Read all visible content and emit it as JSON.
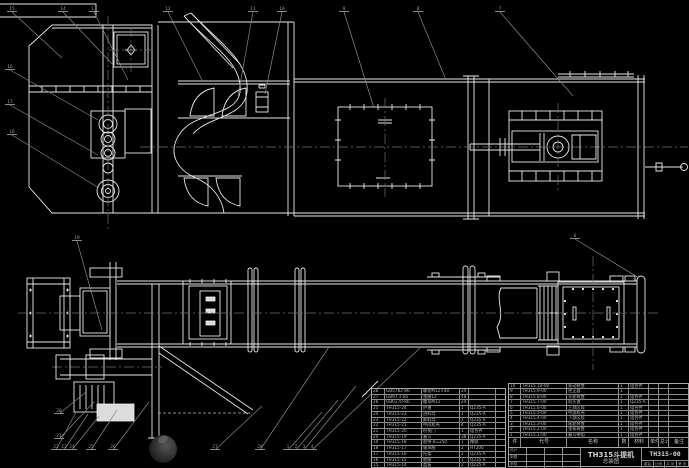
{
  "meta": {
    "background": "#000000",
    "line_color": "#e9e9e9",
    "centerline_color": "#6f6f6f",
    "callout_color": "#9a9a9a"
  },
  "title_block": {
    "product": "TH315斗提机",
    "sheet_name": "总装图",
    "drawing_no": "TH315-00",
    "fields": {
      "weight": "重量",
      "scale": "比例",
      "sheets": "共 张",
      "sheet_no": "第 张"
    },
    "sign_rows": [
      {
        "label": "设计"
      },
      {
        "label": "制图"
      },
      {
        "label": "审核"
      }
    ]
  },
  "bom_right": {
    "headers": [
      "件",
      "代号",
      "名称",
      "数",
      "材料",
      "单件",
      "总计",
      "备注"
    ],
    "rows": [
      {
        "no": "10",
        "code": "TH315.10-00",
        "name": "驱动装置",
        "qty": "1",
        "mat": "组合件",
        "w1": "",
        "w2": "",
        "note": ""
      },
      {
        "no": "9",
        "code": "TH315.9-00",
        "name": "逆止器",
        "qty": "1",
        "mat": "",
        "w1": "",
        "w2": "",
        "note": ""
      },
      {
        "no": "8",
        "code": "TH315.8-00",
        "name": "头轮装置",
        "qty": "1",
        "mat": "组合件",
        "w1": "",
        "w2": "",
        "note": ""
      },
      {
        "no": "7",
        "code": "TH315.7-00",
        "name": "机头罩",
        "qty": "1",
        "mat": "Q235-A",
        "w1": "",
        "w2": "",
        "note": ""
      },
      {
        "no": "6",
        "code": "TH315.6-00",
        "name": "上部区段",
        "qty": "1",
        "mat": "组合件",
        "w1": "",
        "w2": "",
        "note": ""
      },
      {
        "no": "5",
        "code": "TH315.5-00",
        "name": "中部机壳",
        "qty": "1",
        "mat": "组合件",
        "w1": "",
        "w2": "",
        "note": ""
      },
      {
        "no": "4",
        "code": "TH315.4-00",
        "name": "下部区段",
        "qty": "1",
        "mat": "组合件",
        "w1": "",
        "w2": "",
        "note": ""
      },
      {
        "no": "3",
        "code": "TH315.3-00",
        "name": "尾轮装置",
        "qty": "1",
        "mat": "组合件",
        "w1": "",
        "w2": "",
        "note": ""
      },
      {
        "no": "2",
        "code": "TH315.2-00",
        "name": "张紧装置",
        "qty": "1",
        "mat": "组合件",
        "w1": "",
        "w2": "",
        "note": ""
      },
      {
        "no": "1",
        "code": "TH315.1-00",
        "name": "畚斗带组",
        "qty": "1",
        "mat": "组合件",
        "w1": "",
        "w2": "",
        "note": ""
      }
    ]
  },
  "bom_left": {
    "rows": [
      {
        "no": "28",
        "code": "GB5782-86",
        "name": "螺栓M12×40",
        "qty": "24",
        "mat": "",
        "note": ""
      },
      {
        "no": "27",
        "code": "GB97.1-85",
        "name": "垫圈12",
        "qty": "48",
        "mat": "",
        "note": ""
      },
      {
        "no": "26",
        "code": "GB6170-86",
        "name": "螺母M12",
        "qty": "24",
        "mat": "",
        "note": ""
      },
      {
        "no": "25",
        "code": "TH315-24",
        "name": "护罩",
        "qty": "1",
        "mat": "Q235-A",
        "note": ""
      },
      {
        "no": "24",
        "code": "TH315-23",
        "name": "进料口",
        "qty": "1",
        "mat": "Q235-A",
        "note": ""
      },
      {
        "no": "23",
        "code": "TH315-22",
        "name": "卸料口",
        "qty": "1",
        "mat": "Q235-A",
        "note": ""
      },
      {
        "no": "22",
        "code": "TH315-21",
        "name": "中间机壳",
        "qty": "4",
        "mat": "Q235-A",
        "note": ""
      },
      {
        "no": "21",
        "code": "TH315-20",
        "name": "检视门",
        "qty": "1",
        "mat": "组合件",
        "note": ""
      },
      {
        "no": "20",
        "code": "TH315-19",
        "name": "畚斗",
        "qty": "38",
        "mat": "Q235-A",
        "note": ""
      },
      {
        "no": "19",
        "code": "TH315-18",
        "name": "胶带 B=250",
        "qty": "1",
        "mat": "橡胶",
        "note": ""
      },
      {
        "no": "18",
        "code": "TH315-17",
        "name": "轴承座",
        "qty": "2",
        "mat": "HT200",
        "note": ""
      },
      {
        "no": "17",
        "code": "TH315-16",
        "name": "托架",
        "qty": "1",
        "mat": "Q235-A",
        "note": ""
      },
      {
        "no": "16",
        "code": "TH315-15",
        "name": "底座",
        "qty": "1",
        "mat": "Q235-A",
        "note": ""
      },
      {
        "no": "15",
        "code": "TH315-14",
        "name": "盖板",
        "qty": "2",
        "mat": "Q235-A",
        "note": ""
      }
    ]
  },
  "callouts": [
    {
      "n": "15",
      "lx": 10,
      "ly": 9,
      "px": 62,
      "py": 58
    },
    {
      "n": "14",
      "lx": 61,
      "ly": 9,
      "px": 116,
      "py": 68
    },
    {
      "n": "13",
      "lx": 92,
      "ly": 9,
      "px": 128,
      "py": 80
    },
    {
      "n": "12",
      "lx": 166,
      "ly": 9,
      "px": 202,
      "py": 80
    },
    {
      "n": "11",
      "lx": 251,
      "ly": 9,
      "px": 238,
      "py": 96
    },
    {
      "n": "10",
      "lx": 280,
      "ly": 9,
      "px": 265,
      "py": 94
    },
    {
      "n": "9",
      "lx": 342,
      "ly": 9,
      "px": 374,
      "py": 108
    },
    {
      "n": "8",
      "lx": 416,
      "ly": 9,
      "px": 446,
      "py": 80
    },
    {
      "n": "7",
      "lx": 498,
      "ly": 9,
      "px": 573,
      "py": 96
    },
    {
      "n": "16",
      "lx": 8,
      "ly": 67,
      "px": 98,
      "py": 120
    },
    {
      "n": "17",
      "lx": 8,
      "ly": 102,
      "px": 98,
      "py": 155
    },
    {
      "n": "18",
      "lx": 10,
      "ly": 132,
      "px": 99,
      "py": 188
    },
    {
      "n": "19",
      "lx": 75,
      "ly": 238,
      "px": 102,
      "py": 330
    },
    {
      "n": "6",
      "lx": 573,
      "ly": 236,
      "px": 639,
      "py": 278
    },
    {
      "n": "20",
      "lx": 57,
      "ly": 411,
      "px": 86,
      "py": 392
    },
    {
      "n": "21",
      "lx": 57,
      "ly": 436,
      "px": 94,
      "py": 402
    },
    {
      "n": "22",
      "lx": 54,
      "ly": 447,
      "px": 76,
      "py": 412
    },
    {
      "n": "23",
      "lx": 62,
      "ly": 447,
      "px": 88,
      "py": 414
    },
    {
      "n": "24",
      "lx": 70,
      "ly": 447,
      "px": 99,
      "py": 416
    },
    {
      "n": "25",
      "lx": 89,
      "ly": 447,
      "px": 117,
      "py": 410
    },
    {
      "n": "26",
      "lx": 111,
      "ly": 447,
      "px": 149,
      "py": 402
    },
    {
      "n": "27",
      "lx": 213,
      "ly": 447,
      "px": 262,
      "py": 406
    },
    {
      "n": "28",
      "lx": 258,
      "ly": 447,
      "px": 329,
      "py": 347
    },
    {
      "n": "1",
      "lx": 286,
      "ly": 447,
      "px": 322,
      "py": 412
    },
    {
      "n": "2",
      "lx": 294,
      "ly": 447,
      "px": 338,
      "py": 400
    },
    {
      "n": "3",
      "lx": 302,
      "ly": 447,
      "px": 356,
      "py": 386
    },
    {
      "n": "4",
      "lx": 310,
      "ly": 447,
      "px": 420,
      "py": 348
    }
  ]
}
